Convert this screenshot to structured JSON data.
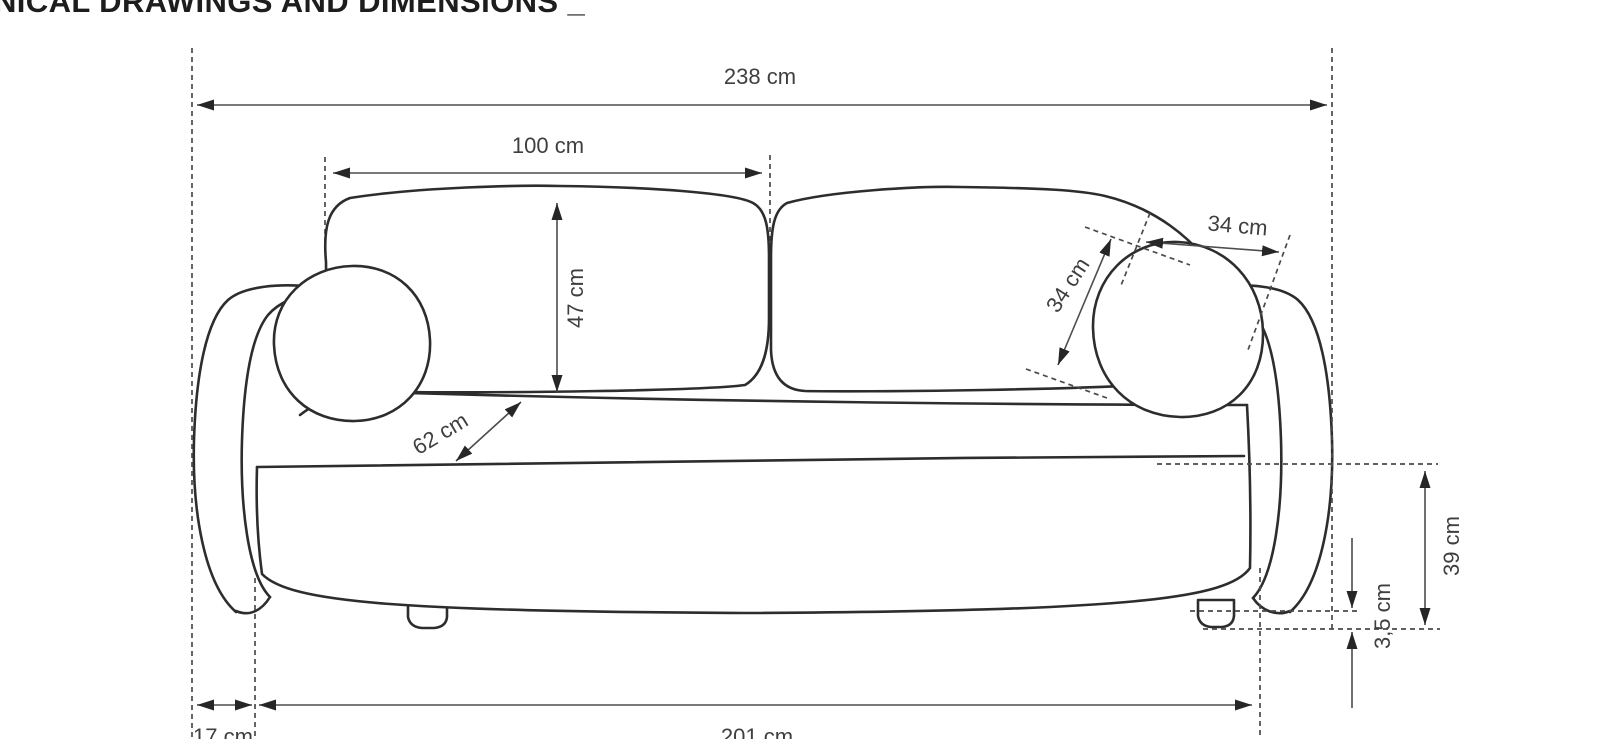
{
  "title": {
    "visible_text": "NICAL DRAWINGS AND DIMENSIONS _"
  },
  "drawing": {
    "type": "technical-drawing",
    "subject": "sofa-front-elevation",
    "unit": "cm",
    "colors": {
      "line": "#2d2d2d",
      "dimension_line": "#4d4d4d",
      "text": "#3f3f3f",
      "background": "#ffffff"
    },
    "dimensions": [
      {
        "id": "overall-width",
        "label": "238 cm",
        "value": 238,
        "orientation": "horizontal"
      },
      {
        "id": "backrest-cushion-width",
        "label": "100 cm",
        "value": 100,
        "orientation": "horizontal"
      },
      {
        "id": "backrest-height",
        "label": "47 cm",
        "value": 47,
        "orientation": "vertical"
      },
      {
        "id": "seat-depth",
        "label": "62 cm",
        "value": 62,
        "orientation": "diagonal"
      },
      {
        "id": "pillow-height",
        "label": "34 cm",
        "value": 34,
        "orientation": "diagonal"
      },
      {
        "id": "pillow-width",
        "label": "34 cm",
        "value": 34,
        "orientation": "horizontal"
      },
      {
        "id": "seat-height",
        "label": "39 cm",
        "value": 39,
        "orientation": "vertical"
      },
      {
        "id": "leg-height",
        "label": "3,5 cm",
        "value": 3.5,
        "orientation": "vertical"
      },
      {
        "id": "arm-depth",
        "label": "17 cm",
        "value": 17,
        "orientation": "horizontal"
      },
      {
        "id": "seat-width",
        "label": "201 cm",
        "value": 201,
        "orientation": "horizontal"
      }
    ]
  }
}
